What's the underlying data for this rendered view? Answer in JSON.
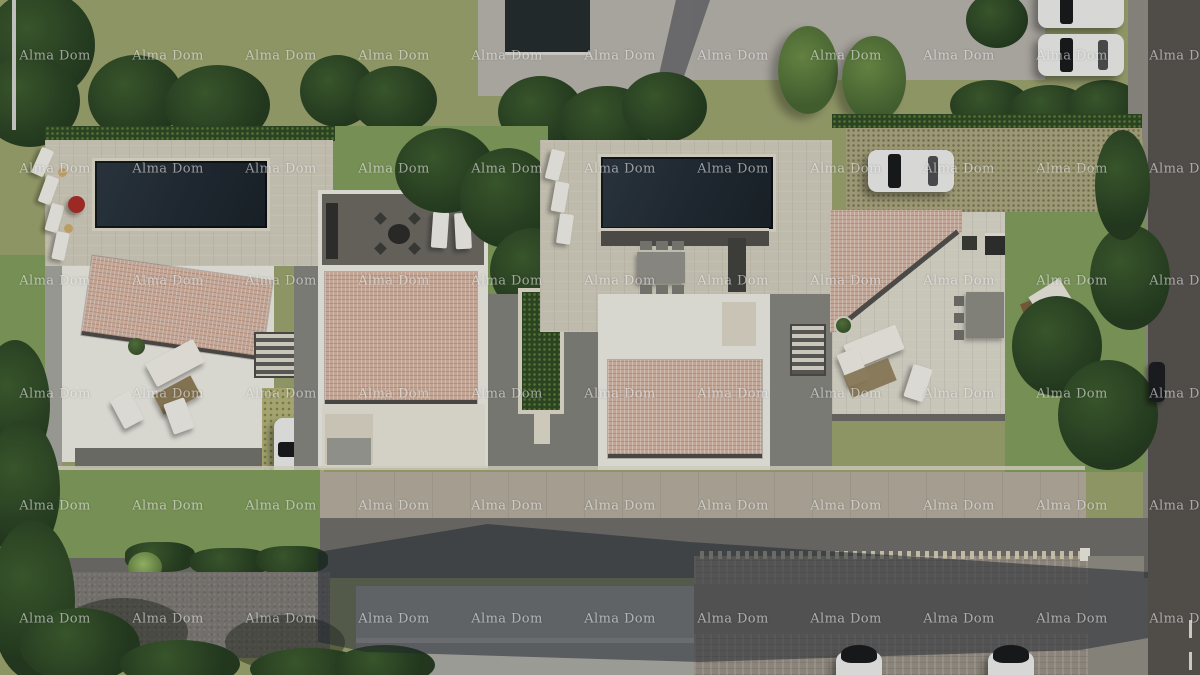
{
  "image": {
    "kind": "aerial 3D architectural rendering of a villa development with pools, terraces, gardens, parked cars and surrounding roads",
    "width_px": 1200,
    "height_px": 675
  },
  "watermark": {
    "text": "Alma Dom",
    "color": "rgba(255,255,255,0.55)",
    "rows": 6,
    "columns": 11,
    "start_x": 55,
    "start_y": 56,
    "spacing_x": 113,
    "spacing_y": 112.5
  },
  "scene_objects": [
    "villa-1-pool",
    "villa-2-rooftop-terrace",
    "villa-3-pool",
    "villa-4-terrace",
    "terracotta-roofs",
    "sun-loungers",
    "outdoor-dining-sets",
    "lounge-sofas",
    "white-cars-parked",
    "dark-car-on-road",
    "access-roads",
    "gravel-driveways",
    "lawns-and-trees",
    "neighbouring-building-roof",
    "parking-area",
    "building-shadow"
  ],
  "palette": {
    "grass_base": "#9aa06b",
    "lawn": "#7e9a58",
    "tree_dark": "#243a1d",
    "tree_mid": "#3c5a2c",
    "hedge": "#2f4722",
    "deck": "#cfc9b8",
    "deck_light": "#ddd8c8",
    "terrace_white": "#e9e6de",
    "pool": "#1f272e",
    "pool_edge": "#dcd7c7",
    "roof_tile": "#d2b19e",
    "roof_edge": "#4c4a46",
    "paving": "#84837c",
    "paving_light": "#a3a29b",
    "concrete": "#b5b0a8",
    "road": "#56524d",
    "road_bottom": "#6e6b65",
    "sidewalk": "#b2aa9a",
    "gravel": "#7b7771",
    "parking": "#968e82",
    "car_white": "#e9e8e4",
    "car_glass": "#17181a",
    "rooftop_deck": "#6b675f",
    "furniture_dark": "#2f2e2b",
    "wood": "#8d7a55",
    "red_accent": "#a82c24",
    "wm_color": "rgba(255,255,255,0.55)",
    "shadow": "rgba(33,38,47,0.52)"
  }
}
